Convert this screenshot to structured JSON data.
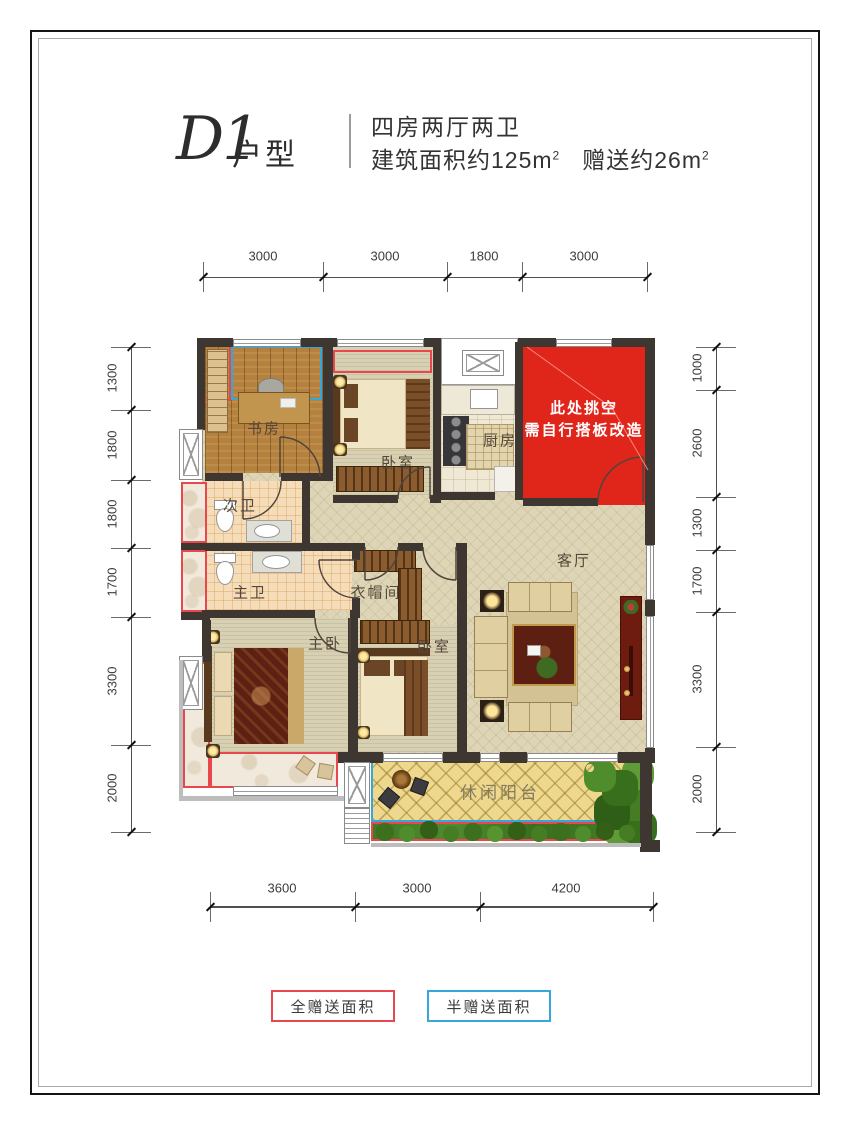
{
  "title": {
    "code": "D1",
    "suffix": "户型"
  },
  "specs": {
    "line1": "四房两厅两卫",
    "area_text": "建筑面积约125m",
    "area_sup": "2",
    "gift_text": "赠送约26m",
    "gift_sup": "2"
  },
  "dimensions": {
    "top": [
      "3000",
      "3000",
      "1800",
      "3000"
    ],
    "bottom": [
      "3600",
      "3000",
      "4200"
    ],
    "left": [
      "1300",
      "1800",
      "1800",
      "1700",
      "3300",
      "2000"
    ],
    "right": [
      "1000",
      "2600",
      "1300",
      "1700",
      "3300",
      "2000"
    ]
  },
  "rooms": {
    "study": "书房",
    "bedroom_top": "卧室",
    "kitchen": "厨房",
    "bath_second": "次卫",
    "bath_master": "主卫",
    "cloakroom": "衣帽间",
    "living": "客厅",
    "master_bedroom": "主卧",
    "bedroom_bottom": "卧室",
    "balcony": "休闲阳台"
  },
  "void_area": {
    "line1": "此处挑空",
    "line2": "需自行搭板改造"
  },
  "legend": {
    "full_gift": "全赠送面积",
    "half_gift": "半赠送面积"
  },
  "colors": {
    "void_red": "#e0251b",
    "outline_red": "#e8474d",
    "outline_blue": "#35a7dc",
    "wall": "#3e3731"
  }
}
